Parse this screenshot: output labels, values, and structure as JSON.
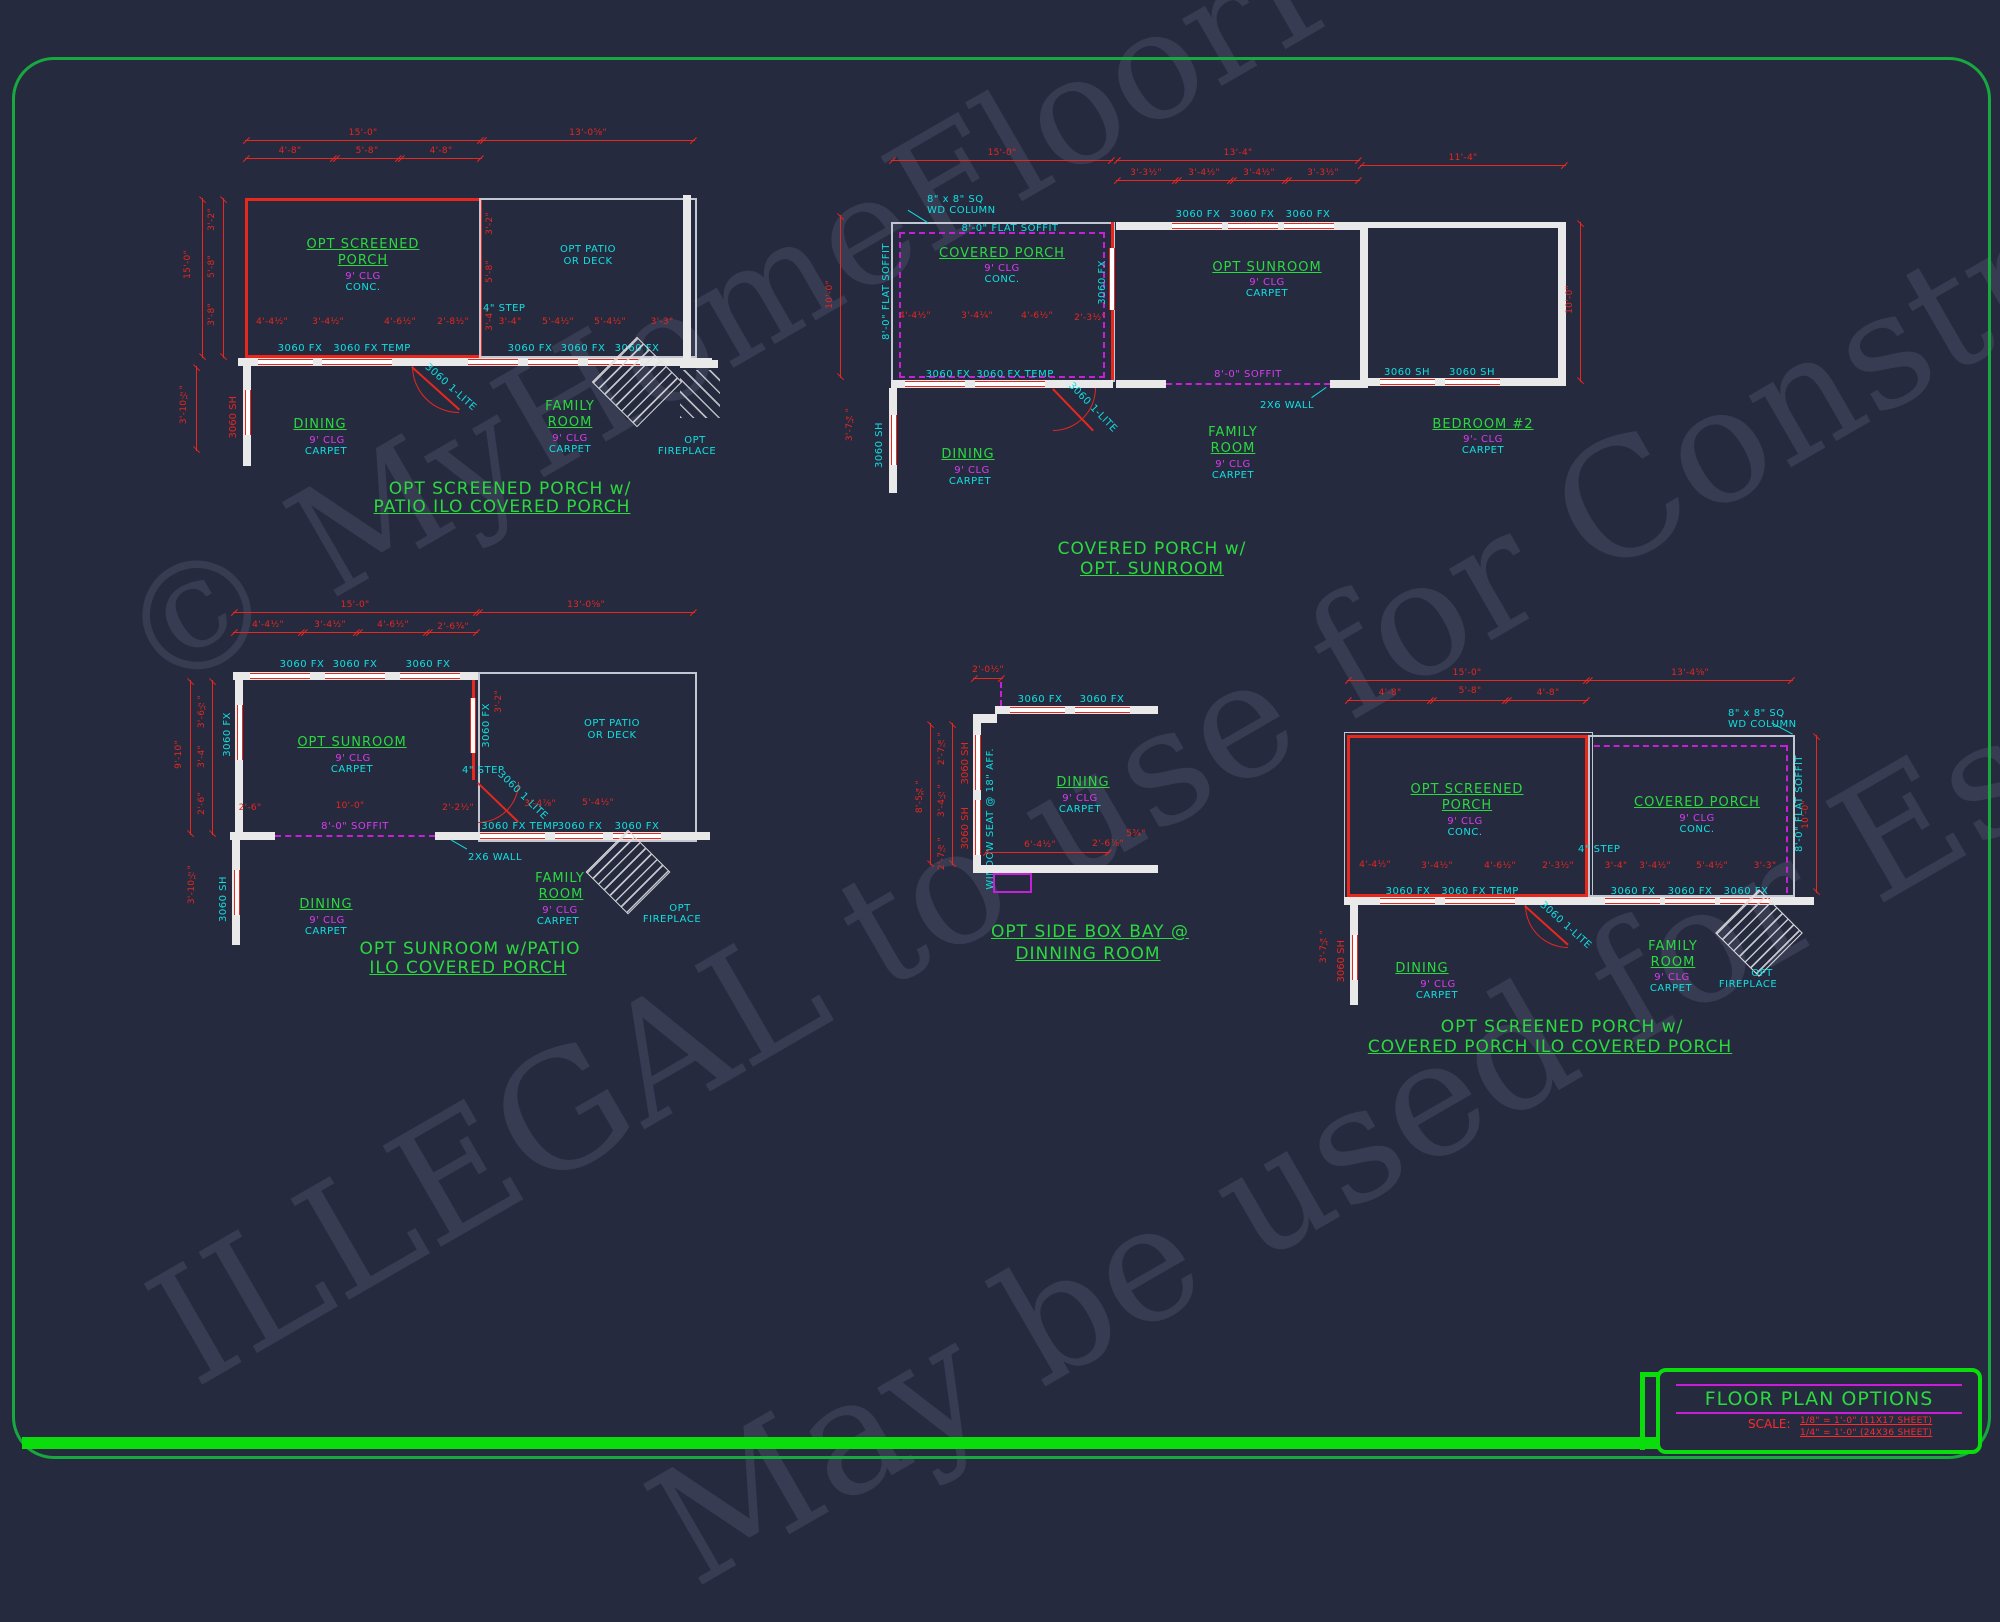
{
  "colors": {
    "red": "#e8271d",
    "green": "#2bd93f",
    "cyan": "#0fe0e0",
    "magenta": "#d83cf0",
    "soffit_magenta": "#c71fd8",
    "background": "#262a3f",
    "border_green": "#17a83e",
    "bar_green": "#0bdc0b"
  },
  "wm": {
    "l1": "© MyHomeFloorPlans.com",
    "l2": "ILLEGAL to use for Constructions",
    "l3": "May be used for Estimations"
  },
  "tb": {
    "title": "FLOOR PLAN OPTIONS",
    "scale": "SCALE:",
    "s1": "1/8\" = 1'-0\" (11X17 SHEET)",
    "s2": "1/4\" = 1'-0\" (24X36 SHEET)"
  },
  "p1": {
    "caption1": "OPT SCREENED PORCH w/",
    "caption2": "PATIO ILO COVERED PORCH",
    "room1a": "OPT SCREENED",
    "room1b": "PORCH",
    "room1clg": "9' CLG",
    "room1fl": "CONC.",
    "patioa": "OPT PATIO",
    "patiob": "OR DECK",
    "dining": "DINING",
    "diningclg": "9' CLG",
    "diningfl": "CARPET",
    "fama": "FAMILY",
    "famb": "ROOM",
    "famclg": "9' CLG",
    "famfl": "CARPET",
    "fpa": "OPT",
    "fpb": "FIREPLACE",
    "step": "4\" STEP",
    "door": "3060 1-LITE",
    "w1": "3060 FX",
    "w2": "3060 FX TEMP",
    "w3": "3060 FX",
    "w4": "3060 FX",
    "w5": "3060 FX",
    "wsh": "3060 SH",
    "dt1": "15'-0\"",
    "dt2": "13'-0⅝\"",
    "dt3": "4'-8\"",
    "dt4": "5'-8\"",
    "dt5": "4'-8\"",
    "dl1": "15'-0\"",
    "dl2": "3'-2\"",
    "dl3": "5'-8\"",
    "dl4": "3'-8\"",
    "dl5": "3'-10½\"",
    "db1": "4'-4½\"",
    "db2": "3'-4½\"",
    "db3": "4'-6½\"",
    "db4": "2'-8½\"",
    "db5": "3'-4\"",
    "db6": "5'-4½\"",
    "db7": "5'-4½\"",
    "db8": "3'-3\"",
    "dr1": "3'-2\"",
    "dr2": "5'-8\"",
    "dr3": "3'-4\""
  },
  "p2": {
    "caption1": "COVERED PORCH w/",
    "caption2": "OPT. SUNROOM",
    "porcha": "COVERED PORCH",
    "porchclg": "9' CLG",
    "porchfl": "CONC.",
    "suna": "OPT SUNROOM",
    "sunclg": "9' CLG",
    "sunfl": "CARPET",
    "beda": "BEDROOM #2",
    "bedclg": "9'- CLG",
    "bedfl": "CARPET",
    "dining": "DINING",
    "diningclg": "9' CLG",
    "diningfl": "CARPET",
    "fama": "FAMILY",
    "famb": "ROOM",
    "famclg": "9' CLG",
    "famfl": "CARPET",
    "col1": "8\" x 8\" SQ",
    "col2": "WD COLUMN",
    "sfh": "8'-0\" FLAT SOFFIT",
    "sfv": "8'-0\" FLAT SOFFIT",
    "soffit": "8'-0\" SOFFIT",
    "wall26": "2X6 WALL",
    "door": "3060 1-LITE",
    "w1": "3060 FX",
    "w2": "3060 FX TEMP",
    "sw1": "3060 FX",
    "sw2": "3060 FX",
    "sw3": "3060 FX",
    "wv": "3060 FX",
    "sh1": "3060 SH",
    "sh2": "3060 SH",
    "shd": "3060 SH",
    "dt1": "15'-0\"",
    "dt2": "13'-4\"",
    "dt3": "11'-4\"",
    "ds1": "3'-3½\"",
    "ds2": "3'-4½\"",
    "ds3": "3'-4½\"",
    "ds4": "3'-3½\"",
    "db1": "4'-4½\"",
    "db2": "3'-4¼\"",
    "db3": "4'-6½\"",
    "db4": "2'-3½\"",
    "dv1": "10'-0\"",
    "dv2": "10'-0\"",
    "dv3": "3'-7¼\""
  },
  "p3": {
    "caption1": "OPT SUNROOM w/PATIO",
    "caption2": "ILO COVERED PORCH",
    "room1a": "OPT SUNROOM",
    "room1clg": "9' CLG",
    "room1fl": "CARPET",
    "patioa": "OPT PATIO",
    "patiob": "OR DECK",
    "dining": "DINING",
    "diningclg": "9' CLG",
    "diningfl": "CARPET",
    "fama": "FAMILY",
    "famb": "ROOM",
    "famclg": "9' CLG",
    "famfl": "CARPET",
    "fpa": "OPT",
    "fpb": "FIREPLACE",
    "step": "4\" STEP",
    "door": "3060 1-LITE",
    "soffit": "8'-0\" SOFFIT",
    "wall26": "2X6 WALL",
    "w1": "3060 FX",
    "w2": "3060 FX",
    "w3": "3060 FX",
    "w4": "3060 FX TEMP",
    "w5": "3060 FX",
    "w6": "3060 FX",
    "wv1": "3060 FX",
    "wv2": "3060 FX",
    "wsh1": "3060 SH",
    "dt1": "15'-0\"",
    "dt2": "13'-0⅝\"",
    "ds1": "4'-4½\"",
    "ds2": "3'-4½\"",
    "ds3": "4'-6½\"",
    "ds4": "2'-6¾\"",
    "dl1": "9'-10\"",
    "dl2": "3'-6½\"",
    "dl3": "3'-4\"",
    "dl4": "2'-6\"",
    "dl5": "3'-10½\"",
    "db1": "2'-6\"",
    "db2": "10'-0\"",
    "db3": "2'-2½\"",
    "db4": "3'-4⅞\"",
    "db5": "5'-4½\"",
    "dr1": "3'-2\""
  },
  "p4": {
    "caption1": "OPT SIDE BOX BAY @",
    "caption2": "DINNING ROOM",
    "dining": "DINING",
    "diningclg": "9' CLG",
    "diningfl": "CARPET",
    "seat": "WINDOW SEAT @ 18\" AFF.",
    "w1": "3060 FX",
    "w2": "3060 FX",
    "sh1": "3060 SH",
    "sh2": "3060 SH",
    "dl1": "8'-5¾\"",
    "dl2": "2'-7⅞\"",
    "dl3": "3'-4½\"",
    "dl4": "2'-7⅞\"",
    "dt1": "2'-0½\"",
    "db1": "6'-4½\"",
    "db2": "2'-6⅞\"",
    "db3": "5¾\""
  },
  "p5": {
    "caption1": "OPT SCREENED PORCH w/",
    "caption2": "COVERED PORCH ILO COVERED PORCH",
    "room1a": "OPT SCREENED",
    "room1b": "PORCH",
    "room1clg": "9' CLG",
    "room1fl": "CONC.",
    "porcha": "COVERED PORCH",
    "porchclg": "9' CLG",
    "porchfl": "CONC.",
    "col1": "8\" x 8\" SQ",
    "col2": "WD COLUMN",
    "sfv": "8'-0\" FLAT SOFFIT",
    "dining": "DINING",
    "diningclg": "9' CLG",
    "diningfl": "CARPET",
    "fama": "FAMILY",
    "famb": "ROOM",
    "famclg": "9' CLG",
    "famfl": "CARPET",
    "fpa": "OPT",
    "fpb": "FIREPLACE",
    "step": "4\" STEP",
    "door": "3060 1-LITE",
    "w1": "3060 FX",
    "w2": "3060 FX TEMP",
    "w3": "3060 FX",
    "w4": "3060 FX",
    "w5": "3060 FX",
    "wsh": "3060 SH",
    "dt1": "15'-0\"",
    "dt2": "13'-4⅝\"",
    "dt3": "4'-8\"",
    "dt4": "5'-8\"",
    "dt5": "4'-8\"",
    "db1": "4'-4½\"",
    "db2": "3'-4½\"",
    "db3": "4'-6½\"",
    "db4": "2'-3½\"",
    "db5": "3'-4\"",
    "db6": "3'-4½\"",
    "db7": "5'-4½\"",
    "db8": "3'-3\"",
    "dv1": "10'-0\"",
    "dl1": "3'-7¼\""
  }
}
